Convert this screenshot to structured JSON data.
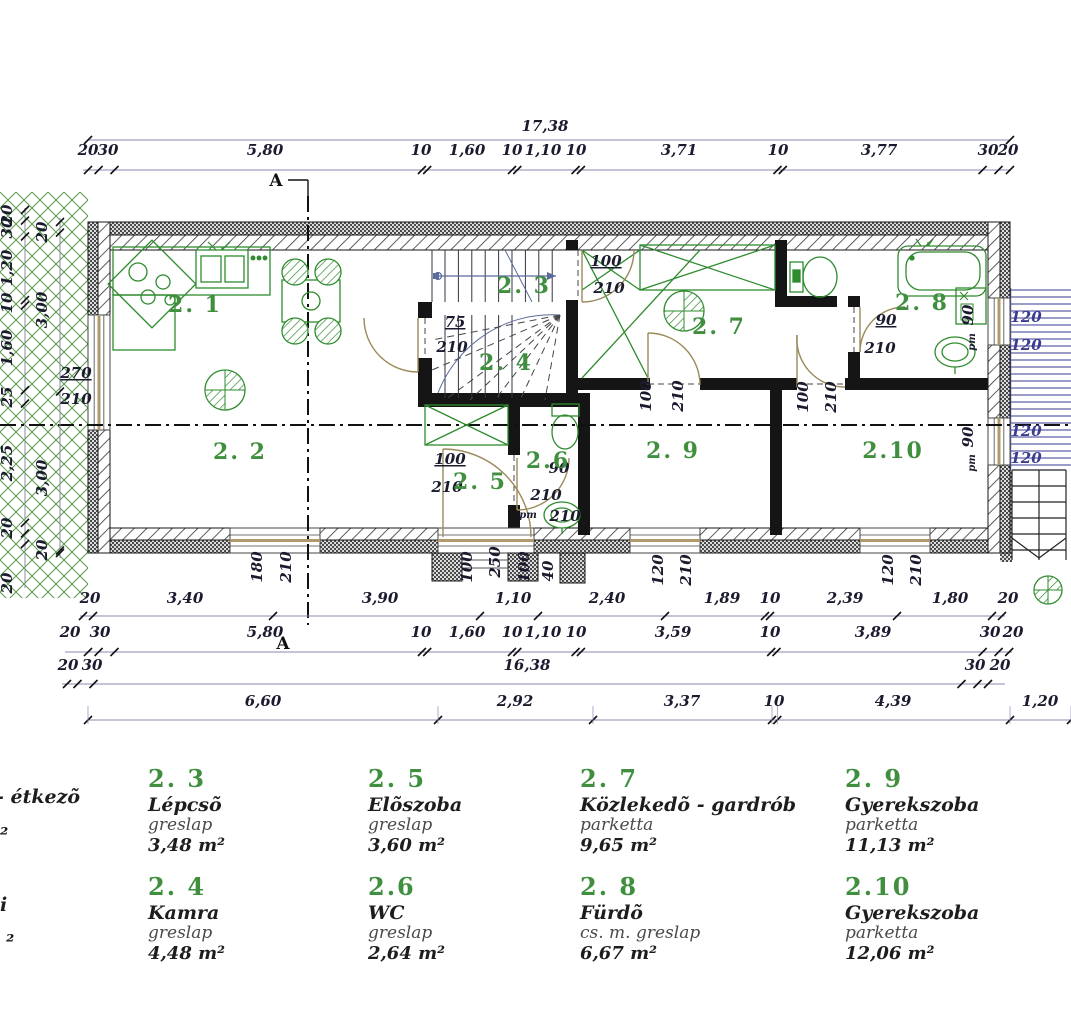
{
  "plan": {
    "dims": {
      "top_total": "17,38",
      "top_row": [
        "20",
        "30",
        "5,80",
        "10",
        "1,60",
        "10",
        "1,10",
        "10",
        "3,71",
        "10",
        "3,77",
        "30",
        "20"
      ],
      "bottom_row1": [
        "20",
        "3,40",
        "3,90",
        "1,10",
        "2,40",
        "1,89",
        "10",
        "2,39",
        "1,80",
        "20"
      ],
      "bottom_row2": [
        "20",
        "30",
        "5,80",
        "10",
        "1,60",
        "10",
        "1,10",
        "10",
        "3,59",
        "10",
        "3,89",
        "30",
        "20"
      ],
      "bottom_row3": [
        "20",
        "30",
        "16,38",
        "30",
        "20"
      ],
      "bottom_row4": [
        "6,60",
        "2,92",
        "3,37",
        "10",
        "4,39",
        "1,20"
      ],
      "left_outer": [
        "20",
        "30",
        "1,20",
        "10",
        "1,60",
        "25",
        "2,25",
        "20",
        "20"
      ],
      "left_inner": [
        "20",
        "3,00",
        "3,00",
        "20"
      ]
    },
    "annotations": [
      "75",
      "210",
      "100",
      "210",
      "100",
      "210",
      "90",
      "210",
      "pm",
      "210",
      "90",
      "210",
      "100",
      "210",
      "100",
      "210",
      "100",
      "250",
      "100",
      "40",
      "180",
      "210",
      "120",
      "210",
      "120",
      "210",
      "90",
      "pm",
      "90",
      "pm",
      "120",
      "120",
      "120",
      "120",
      "270",
      "210"
    ],
    "room_labels": [
      "2. 1",
      "2. 2",
      "2. 3",
      "2. 4",
      "2. 5",
      "2.6",
      "2. 7",
      "2. 8",
      "2. 9",
      "2.10"
    ],
    "section_mark": "A"
  },
  "legend": {
    "cutoff_fragments": [
      "- étkezõ",
      "²",
      "i",
      "²"
    ],
    "entries": [
      {
        "number": "2. 3",
        "name": "Lépcsõ",
        "material": "greslap",
        "area": "3,48 m²"
      },
      {
        "number": "2. 4",
        "name": "Kamra",
        "material": "greslap",
        "area": "4,48 m²"
      },
      {
        "number": "2. 5",
        "name": "Elõszoba",
        "material": "greslap",
        "area": "3,60 m²"
      },
      {
        "number": "2.6",
        "name": "WC",
        "material": "greslap",
        "area": "2,64 m²"
      },
      {
        "number": "2. 7",
        "name": "Közlekedõ - gardrób",
        "material": "parketta",
        "area": "9,65 m²"
      },
      {
        "number": "2. 8",
        "name": "Fürdõ",
        "material": "cs. m. greslap",
        "area": "6,67 m²"
      },
      {
        "number": "2. 9",
        "name": "Gyerekszoba",
        "material": "parketta",
        "area": "11,13 m²"
      },
      {
        "number": "2.10",
        "name": "Gyerekszoba",
        "material": "parketta",
        "area": "12,06 m²"
      }
    ]
  },
  "colors": {
    "accent_green": "#3f8f3f",
    "furniture_green": "#2e8b2e",
    "dim_line_blue": "#8888b0",
    "door_tan": "#9a8a5a",
    "stair_blue": "#5b5ba8",
    "vegetation_green": "#5a9a4a",
    "wall_black": "#151515"
  }
}
